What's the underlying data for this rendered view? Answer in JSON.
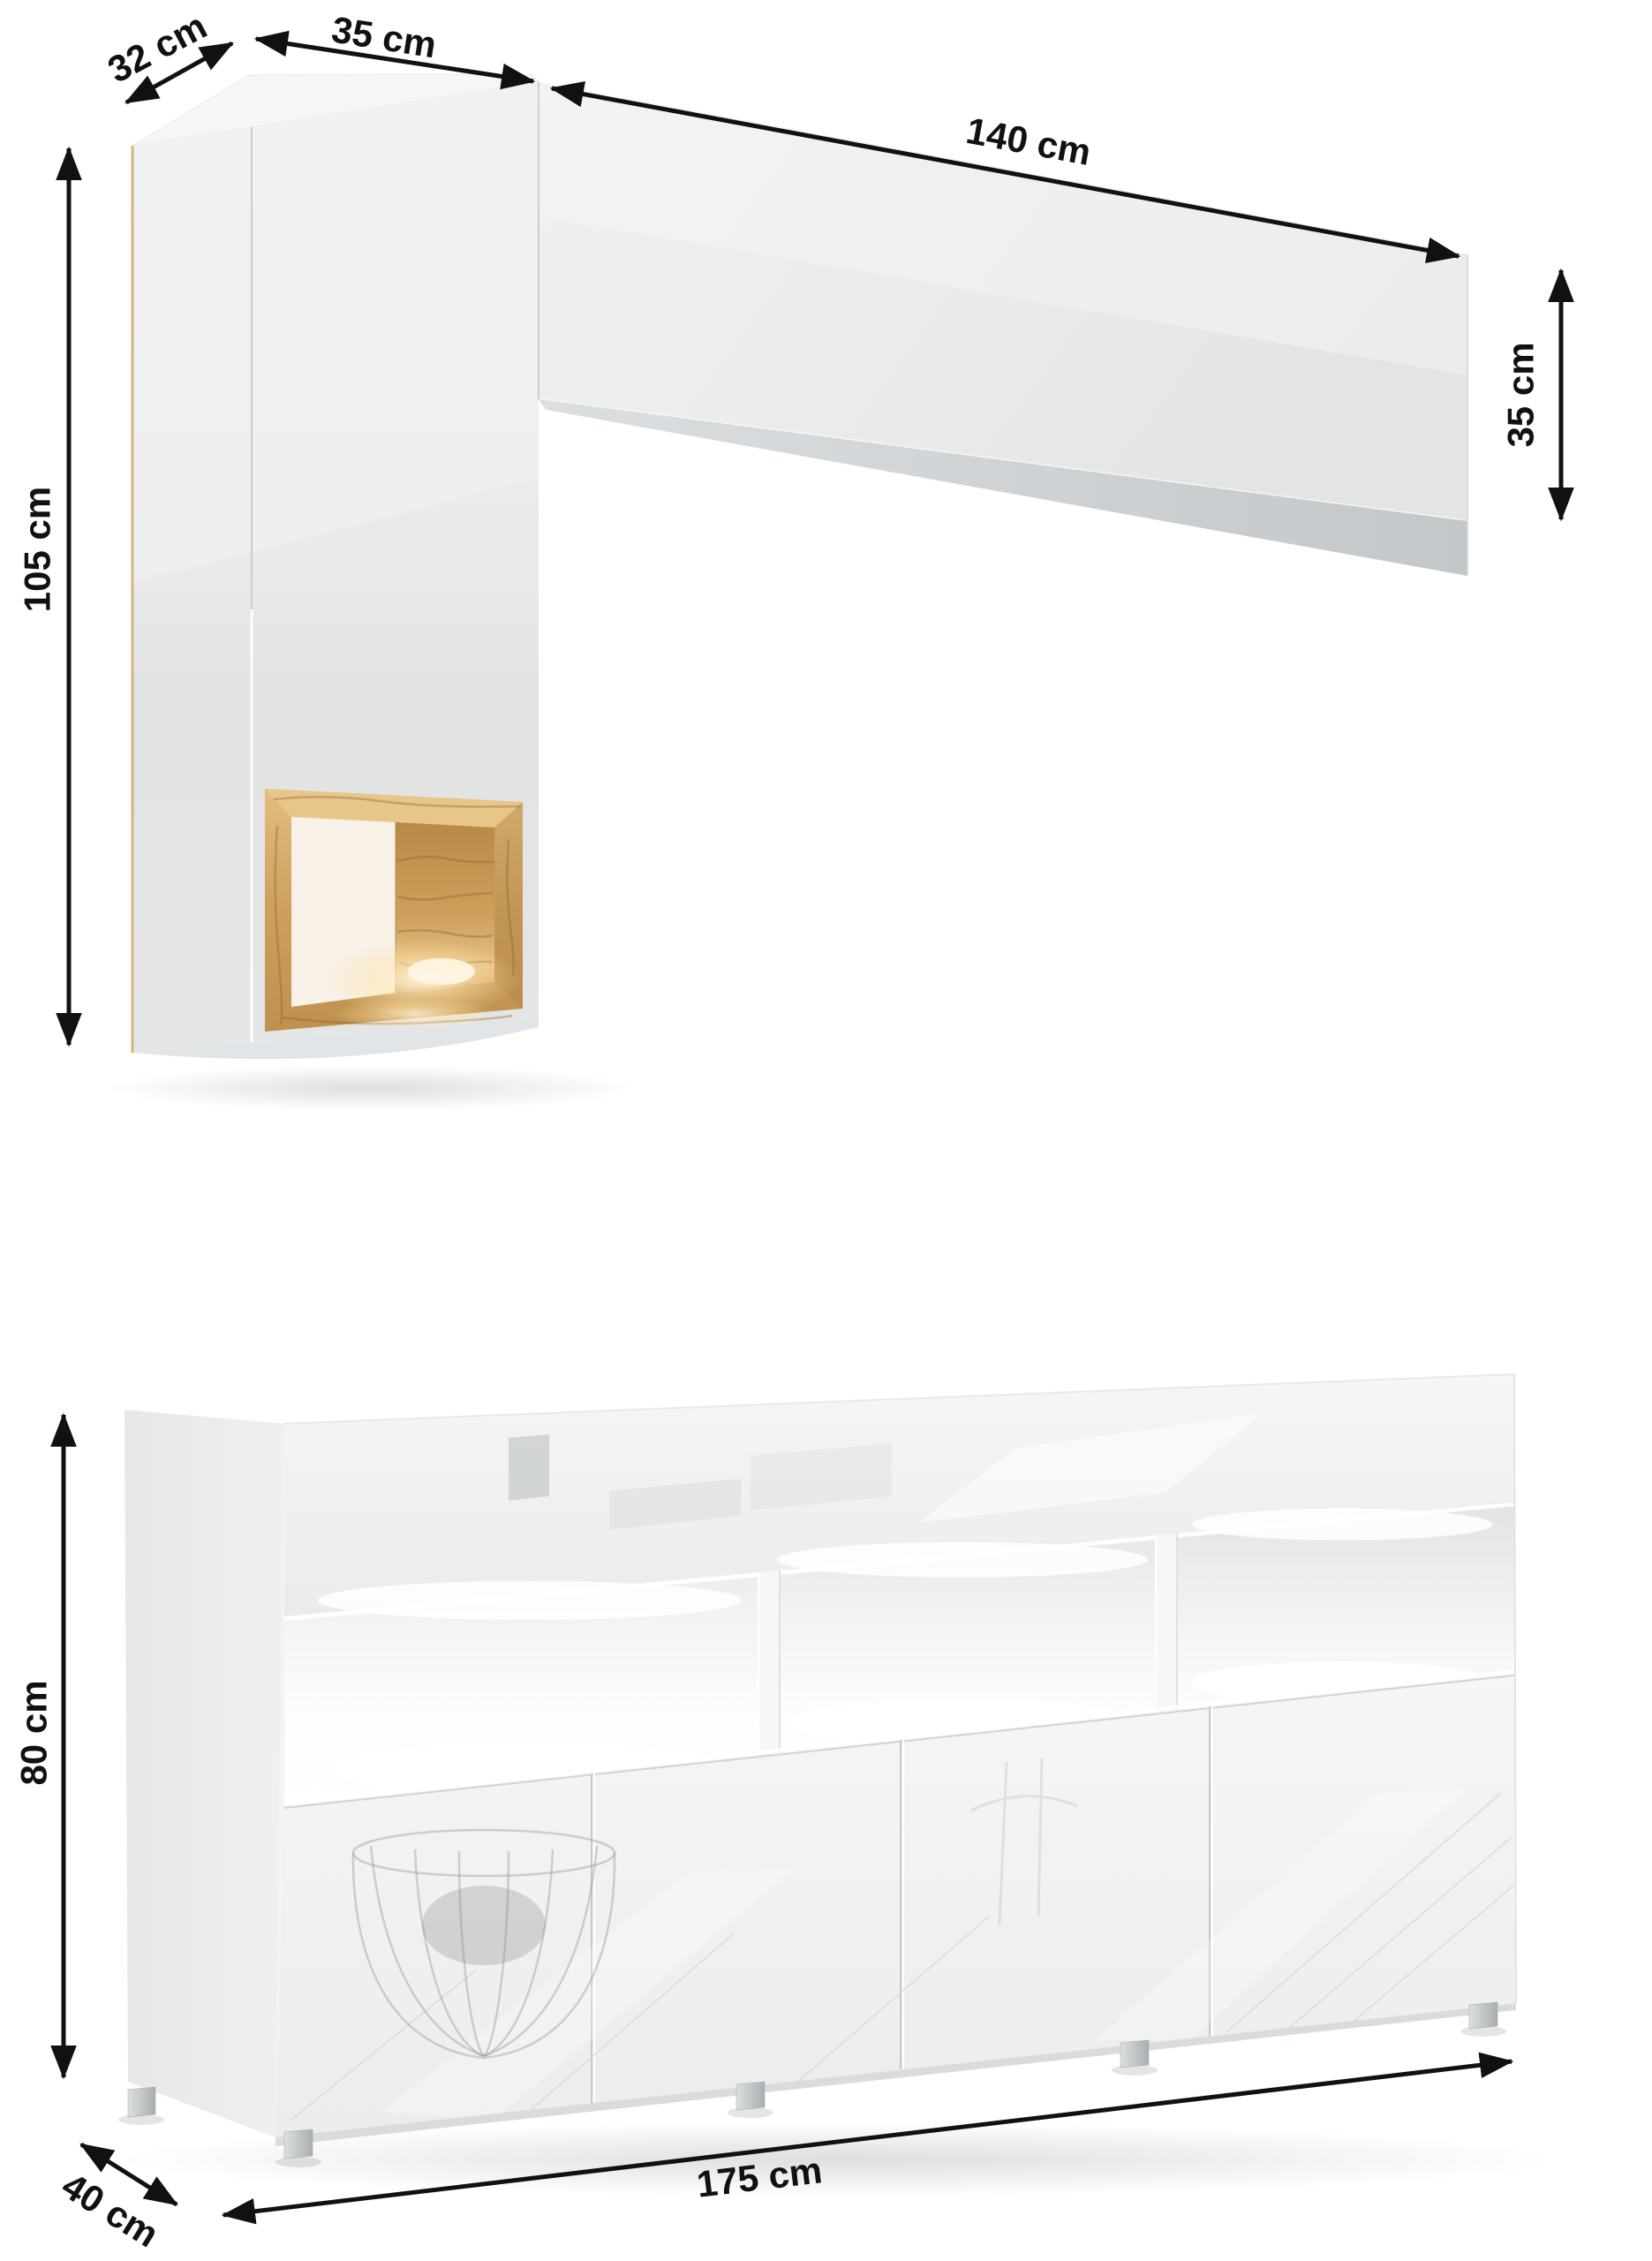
{
  "page": {
    "background": "#ffffff",
    "unit": "cm"
  },
  "wall_unit": {
    "dim_depth": "32 cm",
    "dim_width_cabinet": "35 cm",
    "dim_width_shelf": "140 cm",
    "dim_height_cabinet": "105 cm",
    "dim_height_shelf": "35 cm",
    "body_color": "#e9eaea",
    "niche_wood_color": "#cda05c"
  },
  "sideboard": {
    "dim_height": "80 cm",
    "dim_width": "175 cm",
    "dim_depth": "40 cm",
    "door_count": 4,
    "open_niche_count": 3,
    "body_color": "#f3f4f4",
    "foot_color": "#c3c7c9"
  },
  "annotation": {
    "arrow_color": "#111111",
    "text_color": "#111111"
  }
}
